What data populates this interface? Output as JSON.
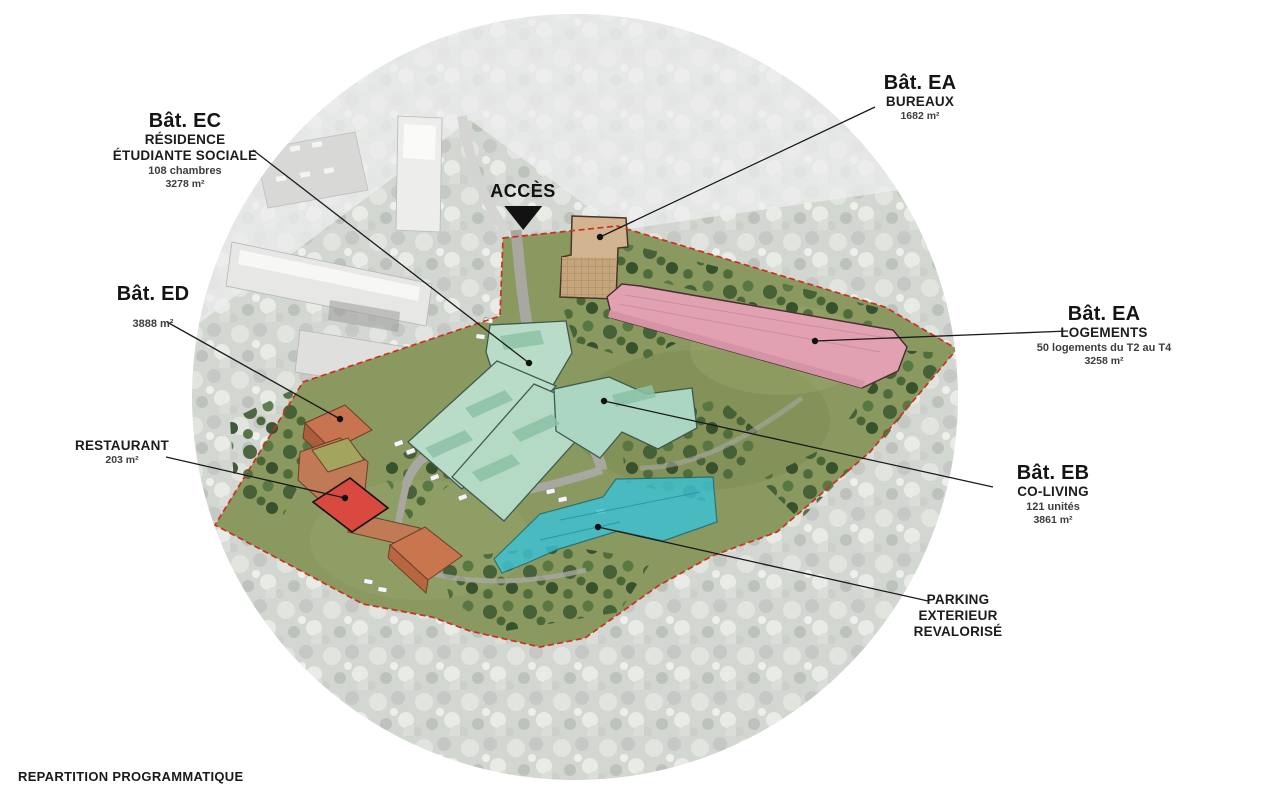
{
  "title": "REPARTITION PROGRAMMATIQUE",
  "access": {
    "label": "ACCÈS"
  },
  "annotations": {
    "ea_bureaux": {
      "name": "Bât. EA",
      "program": "BUREAUX",
      "area": "1682 m²"
    },
    "ec_residence": {
      "name": "Bât. EC",
      "program_line1": "RÉSIDENCE",
      "program_line2": "ÉTUDIANTE SOCIALE",
      "capacity": "108 chambres",
      "area": "3278 m²"
    },
    "ed": {
      "name": "Bât. ED",
      "area": "3888 m²"
    },
    "ea_logements": {
      "name": "Bât. EA",
      "program": "LOGEMENTS",
      "capacity": "50 logements du T2 au T4",
      "area": "3258 m²"
    },
    "restaurant": {
      "name": "RESTAURANT",
      "area": "203 m²"
    },
    "eb_coliving": {
      "name": "Bât. EB",
      "program": "CO-LIVING",
      "capacity": "121 unités",
      "area": "3861 m²"
    },
    "parking": {
      "line1": "PARKING",
      "line2": "EXTERIEUR",
      "line3": "REVALORISÉ"
    }
  },
  "colors": {
    "site_boundary": "#cf2f1f",
    "bureaux": "#d2b491",
    "logements": "#e2a1b1",
    "residence_etudiante": "#b9dcc9",
    "co_living": "#aad6c2",
    "parking_exterieur": "#3bc2d4",
    "bat_ed": "#c97450",
    "restaurant": "#d84a40"
  }
}
